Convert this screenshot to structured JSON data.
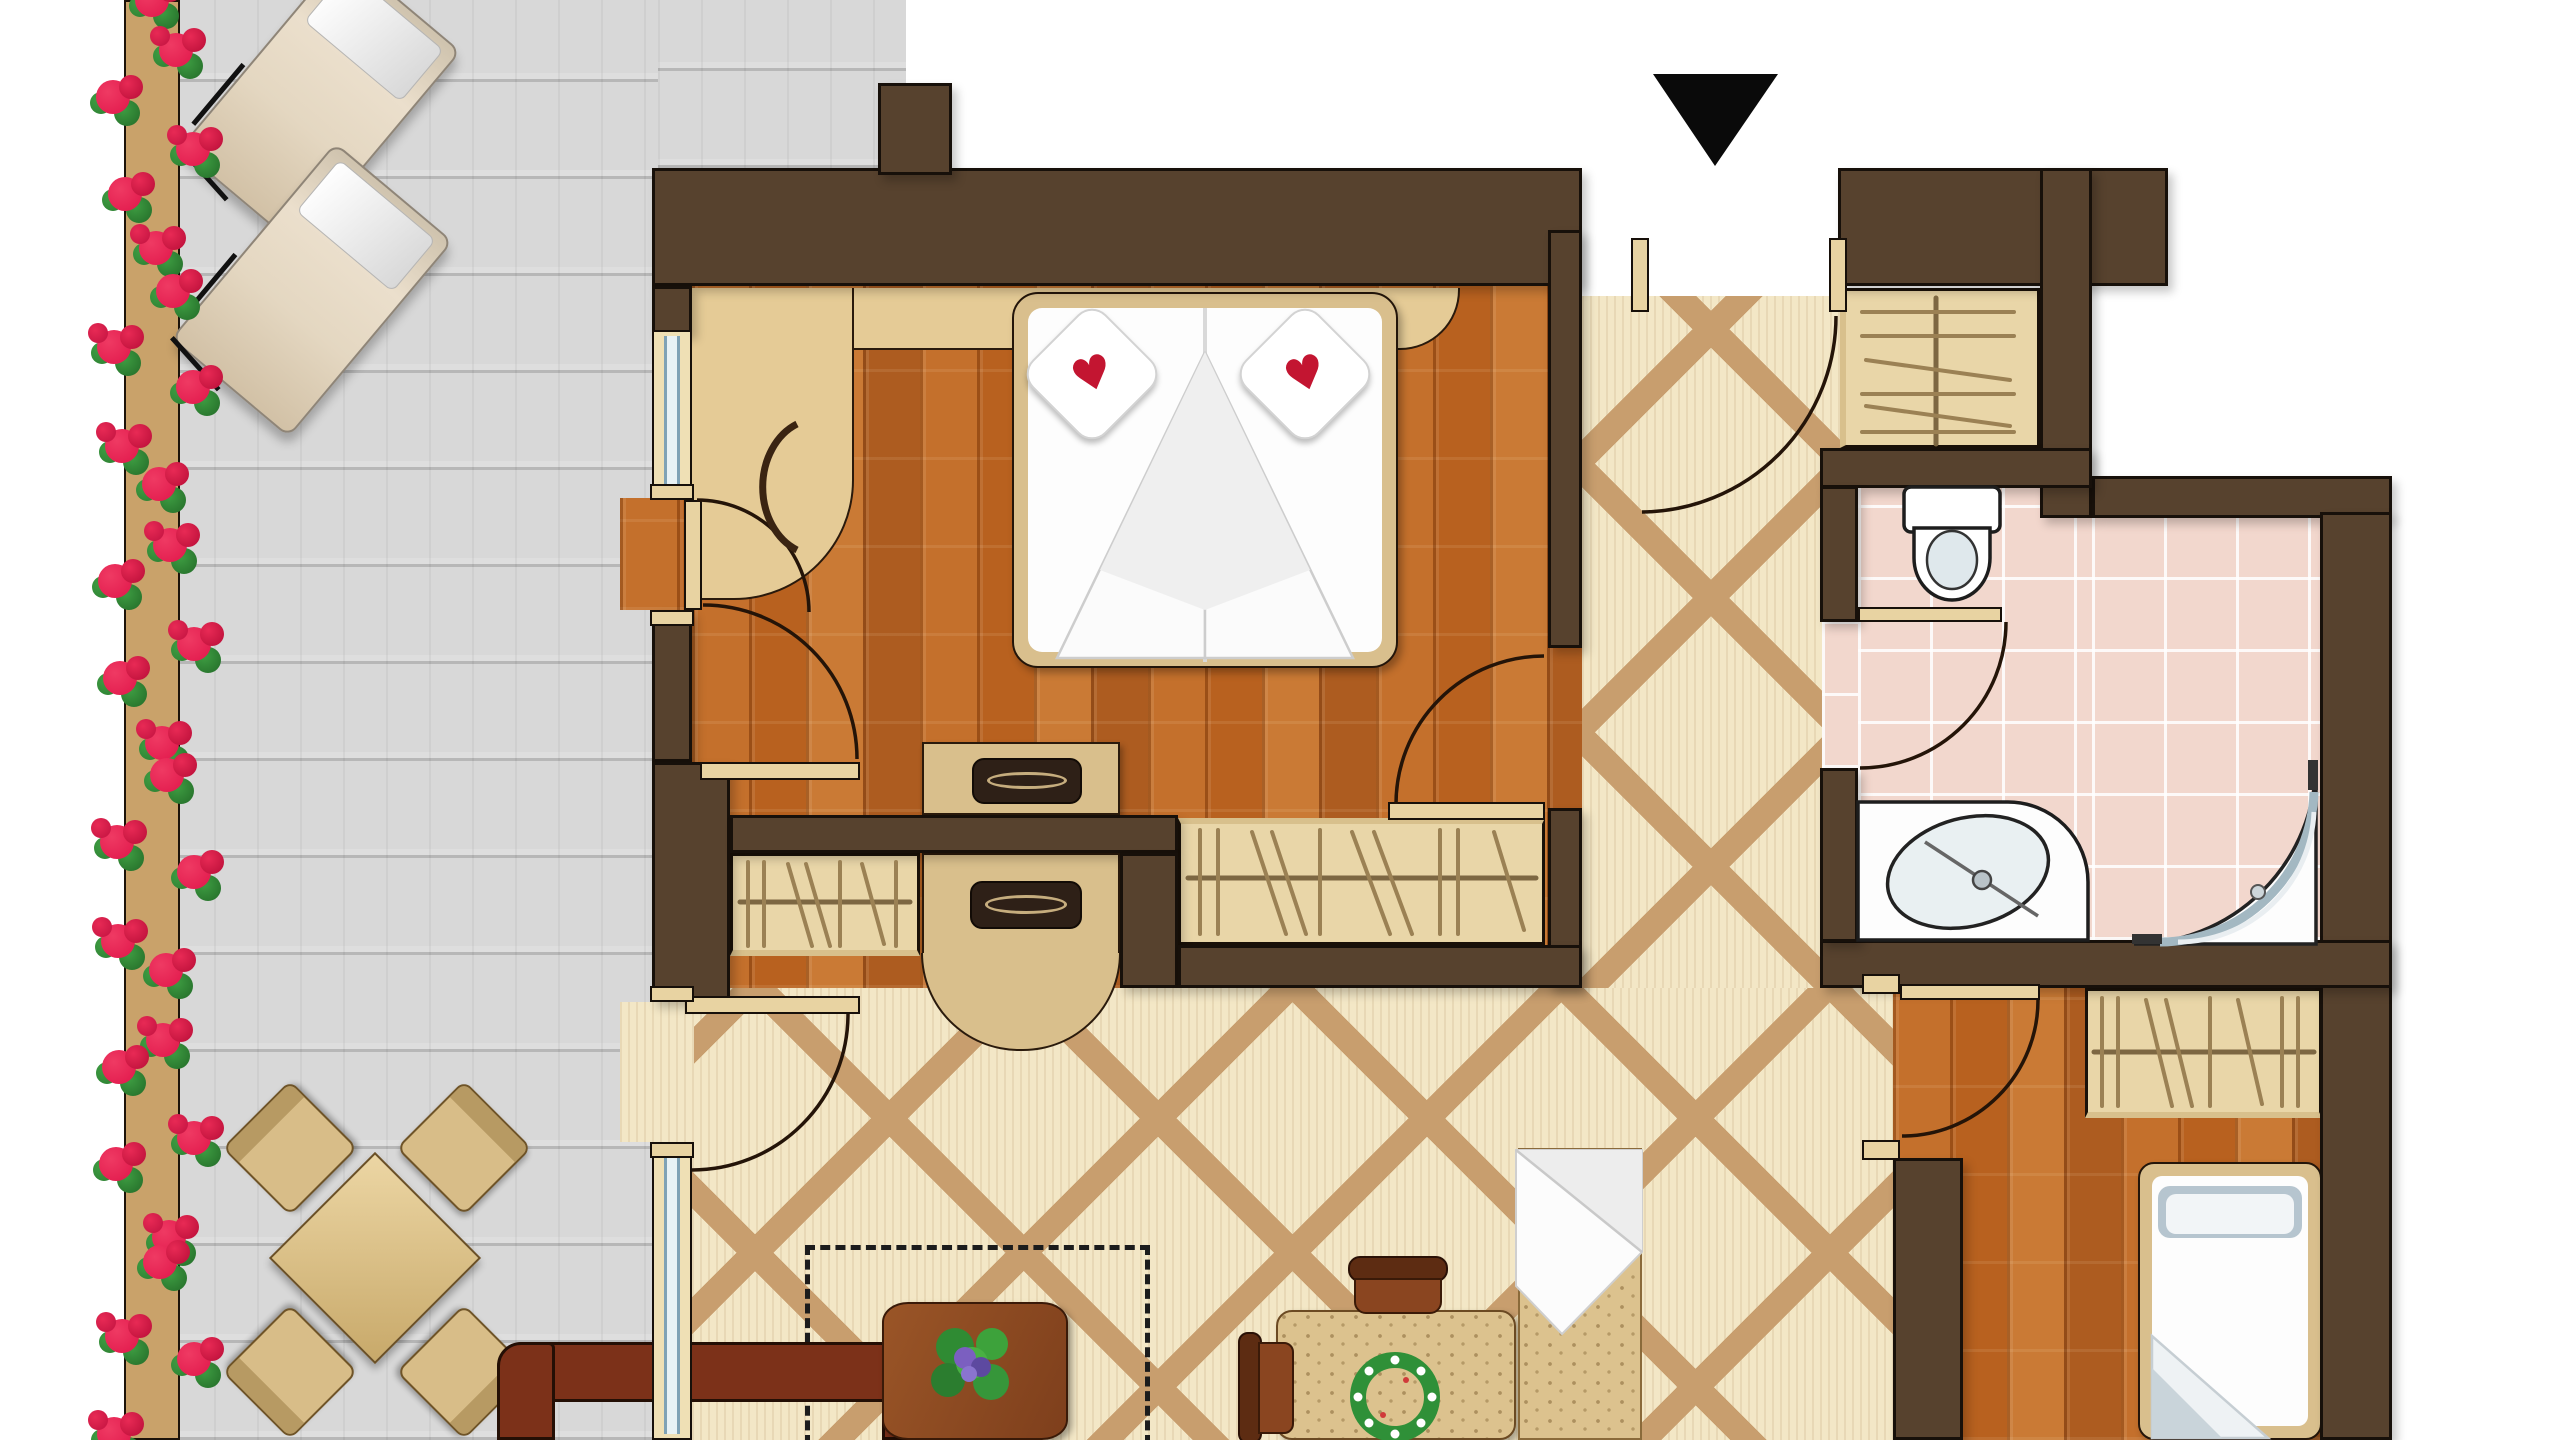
{
  "meta": {
    "type": "floor-plan",
    "view": "top-down",
    "visible_text": "",
    "entrance_marker": "black-triangle-arrow-down"
  },
  "colors": {
    "wall": "#57422e",
    "wall_outline": "#17100a",
    "tile_base": "#f3e7c6",
    "tile_band": "#c89e6e",
    "wood_floor": "#bd6724",
    "deck": "#d9d9d9",
    "bath_pink": "#f2d7cd",
    "furniture_tan": "#d9bf8d",
    "closet_tan": "#e9d6a8",
    "linen_white": "#fdfdfd",
    "heart_red": "#c31531",
    "flower_red": "#e0164a",
    "leaf_green": "#3e9d42",
    "sofa_brown": "#7c3119",
    "plant_purple": "#7b5fc0"
  },
  "rooms": [
    {
      "name": "balcony",
      "floor": "gray-wood-deck",
      "furniture": [
        "flower-box-with-geraniums",
        "sun-lounger",
        "sun-lounger",
        "bistro-table",
        "bistro-chair-x4"
      ]
    },
    {
      "name": "bedroom",
      "floor": "wood-parquet",
      "furniture": [
        "double-bed",
        "heart-pillow-x2",
        "headboard-shelf",
        "desk-with-chair",
        "dresser",
        "wardrobe-with-hangers"
      ]
    },
    {
      "name": "entrance-hall",
      "floor": "diamond-tile",
      "furniture": [
        "coat-closet-with-hangers",
        "console-cabinet"
      ]
    },
    {
      "name": "bathroom",
      "floor": "pink-tile",
      "furniture": [
        "toilet",
        "washbasin-counter",
        "corner-shower"
      ]
    },
    {
      "name": "second-room",
      "floor": "wood-parquet",
      "furniture": [
        "wardrobe-with-hangers",
        "single-bed"
      ]
    },
    {
      "name": "living-dining-area",
      "floor": "diamond-tile",
      "furniture": [
        "sofa",
        "coffee-table-with-plant",
        "dashed-option-outline",
        "dining-table-with-wreath",
        "dining-chair-x2",
        "storage-box-with-blanket"
      ]
    }
  ],
  "doors": [
    "entrance-door",
    "bedroom-door",
    "bedroom-balcony-door",
    "living-balcony-door",
    "bathroom-door",
    "second-room-door"
  ],
  "windows": [
    "bedroom-window",
    "living-room-window"
  ]
}
